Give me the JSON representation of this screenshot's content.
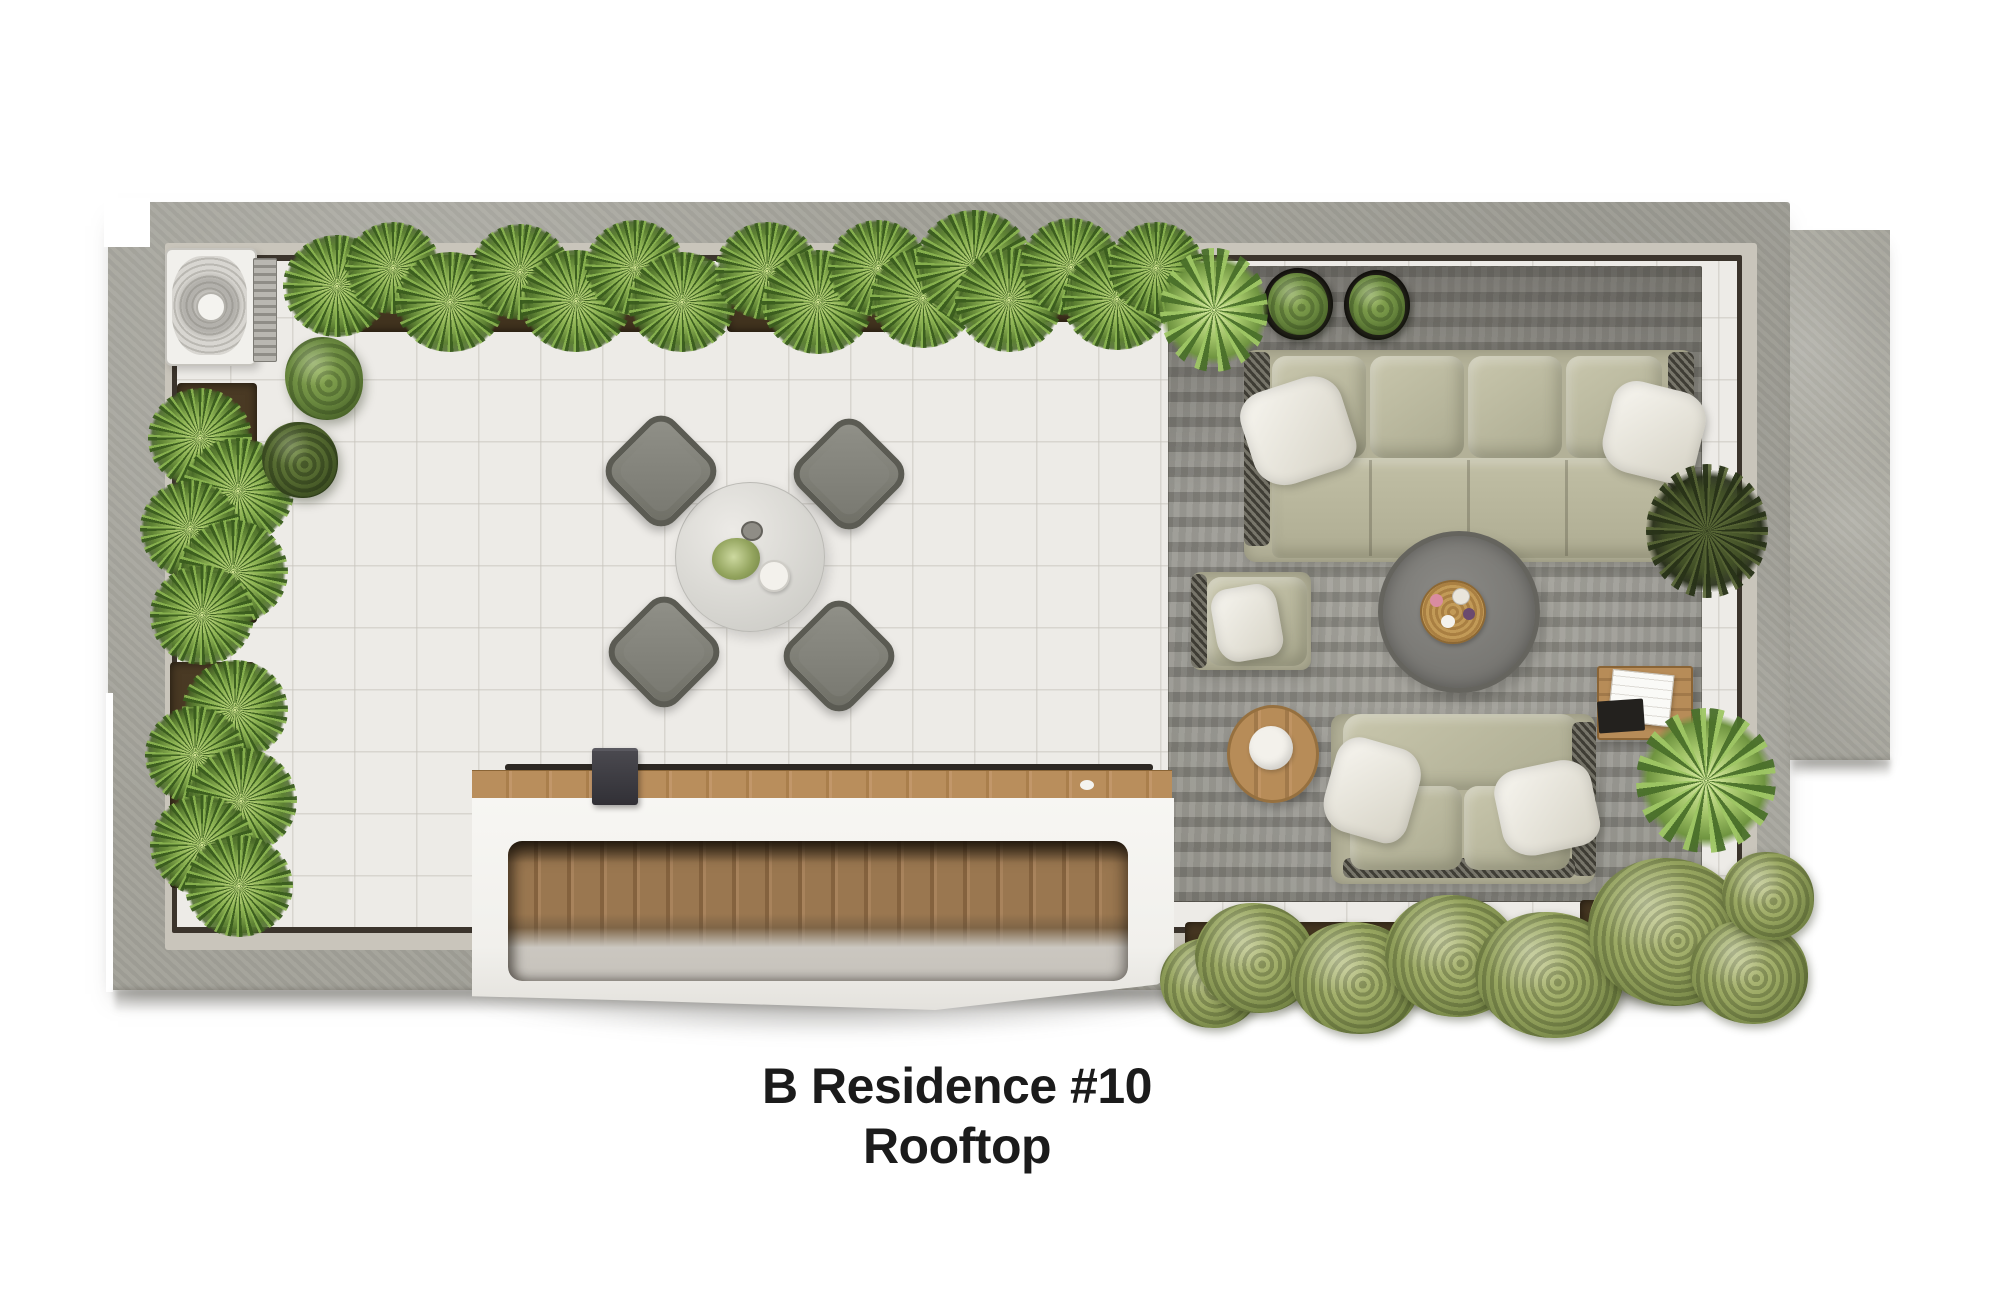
{
  "title": {
    "line1": "B Residence #10",
    "line2": "Rooftop",
    "color": "#1b1b1b"
  },
  "plan": {
    "type": "rooftop-floor-plan-render",
    "areas": [
      "concrete parapet wall",
      "tiled terrace floor",
      "outdoor lounge rug",
      "wood-clad skylight opening"
    ],
    "items": [
      "air-conditioner unit",
      "perimeter planter boxes with grasses",
      "round topiary bushes",
      "round marble dining table with four lounge chairs",
      "large four-seat outdoor sofa with white pillows",
      "two potted bushes",
      "round concrete coffee table with woven tray",
      "sage armchair with pillow",
      "round wooden side table",
      "two-seat loveseat with pillows",
      "square wooden side table with magazine",
      "palm plants",
      "dark spiky plant",
      "olive shrubs along bottom wall",
      "tablet on skylight ledge"
    ],
    "palette": {
      "wall_concrete": "#a3a299",
      "parapet_cap": "#c9c5bb",
      "inner_frame_line": "#3b342c",
      "tile_floor": "#edebe7",
      "rug_gray": "#96958e",
      "sofa_sage": "#b3b198",
      "pillow_white": "#ece9e0",
      "wood": "#b78c58",
      "plant_green": "#6d8c41",
      "olive_green": "#8a9a57",
      "title_text": "#1b1b1b",
      "background": "#ffffff"
    }
  }
}
